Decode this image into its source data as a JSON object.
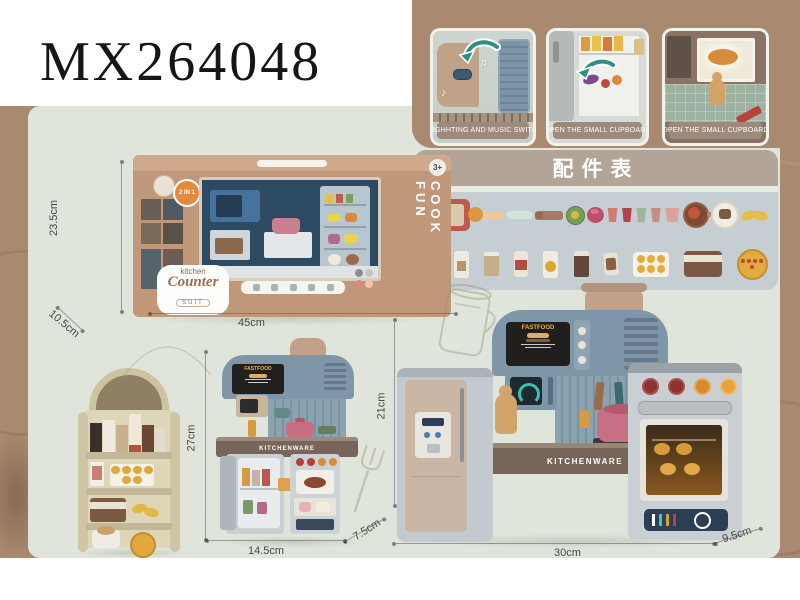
{
  "page": {
    "model_number": "MX264048"
  },
  "feature_photos": [
    {
      "caption": "LIGHHTING AND MUSIC SWITH"
    },
    {
      "caption": "OPEN THE SMALL CUPBOARD"
    },
    {
      "caption": "OPEN THE SMALL CUPBOARD"
    }
  ],
  "accessories_panel": {
    "title": "配件表",
    "rows": [
      {
        "items": [
          {
            "name": "serving-tray",
            "style": "width:46px;height:32px;background:#bf5a4c;border-radius:6px",
            "inner": "left:6px;top:5px;width:34px;height:22px;background:#dac9ad;border-radius:3px"
          },
          {
            "name": "ladle",
            "style": "width:32px;height:9px;background:#eec79c;border-radius:5px",
            "inner": "left:-4px;top:-4px;width:15px;height:15px;border-radius:50%;background:#e0953f"
          },
          {
            "name": "rolling-pin",
            "style": "width:26px;height:8px;background:#d2e3da;border-radius:4px"
          },
          {
            "name": "fork",
            "style": "width:28px;height:9px;background:#ab7a5e;border-radius:3px",
            "inner": "left:0;top:1px;width:8px;height:7px;background:#9a6a50;border-radius:2px"
          },
          {
            "name": "sauce-jar",
            "style": "width:17px;height:17px;border-radius:50%;background:#74a057;border:1px solid #567f3e",
            "inner": "left:4px;top:4px;width:8px;height:8px;border-radius:50%;background:#d8b84a"
          },
          {
            "name": "pink-bowl",
            "style": "width:17px;height:16px;border-radius:50%;background:#bf4d6a",
            "inner": "left:3px;top:2px;width:9px;height:5px;border-radius:50%;background:#d9748c"
          },
          {
            "name": "cup-pink",
            "style": "width:12px;height:14px;background:#d07c70;clip-path:polygon(10% 0,90% 0,78% 100%,22% 100%)"
          },
          {
            "name": "cup-red",
            "style": "width:12px;height:14px;background:#b2434e;clip-path:polygon(10% 0,90% 0,78% 100%,22% 100%)"
          },
          {
            "name": "cup-green",
            "style": "width:12px;height:14px;background:#9db69a;clip-path:polygon(10% 0,90% 0,78% 100%,22% 100%)"
          },
          {
            "name": "cup-tan",
            "style": "width:12px;height:14px;background:#c09180;clip-path:polygon(10% 0,90% 0,78% 100%,22% 100%)"
          },
          {
            "name": "measuring-cup",
            "style": "width:16px;height:14px;background:#dba39c;clip-path:polygon(6% 0,94% 0,82% 100%,18% 100%)"
          },
          {
            "name": "frying-pan",
            "style": "width:22px;height:22px;border-radius:50%;background:#7d4a33;border:2px solid #93604a",
            "inner": "left:3px;top:3px;width:12px;height:12px;border-radius:50%;background:#c2563c",
            "inner2": "left:22px;top:8px;width:11px;height:5px;background:#c18a70;border-radius:3px"
          },
          {
            "name": "dinner-plate",
            "style": "width:24px;height:24px;border-radius:50%;background:#f2ede3;border:2px solid #dcd4c2",
            "inner": "left:6px;top:6px;width:12px;height:10px;background:#7c5c40;border-radius:3px"
          },
          {
            "name": "corn-left",
            "style": "width:16px;height:9px;border-radius:50%;background:#e5bc45;transform:rotate(-18deg)"
          },
          {
            "name": "corn-right",
            "style": "width:16px;height:9px;border-radius:50%;background:#e5bc45;margin-left:-8px;transform:rotate(14deg)"
          }
        ]
      },
      {
        "items": [
          {
            "name": "milk-carton-dark",
            "style": "width:15px;height:26px;background:#423731;border-radius:2px",
            "inner": "left:0;top:0;width:15px;height:5px;background:#ece7de;border-radius:2px 2px 0 0"
          },
          {
            "name": "milk-bottle-white",
            "style": "width:15px;height:27px;background:#efeae1;border-radius:3px",
            "inner": "left:3px;top:10px;width:9px;height:10px;background:#b9926e"
          },
          {
            "name": "milk-carton-tan",
            "style": "width:15px;height:24px;background:#c8ad8c;border-radius:2px",
            "inner": "left:0;top:0;width:15px;height:4px;background:#eee9df;border-radius:2px 2px 0 0"
          },
          {
            "name": "sauce-bottle",
            "style": "width:14px;height:26px;background:#ece5d8;border-radius:3px",
            "inner": "left:1px;top:9px;width:12px;height:10px;background:#b34e3c"
          },
          {
            "name": "honey-bottle",
            "style": "width:15px;height:27px;background:#f1ece2;border-radius:3px",
            "inner": "left:2px;top:10px;width:11px;height:11px;border-radius:50%;background:#d9a832"
          },
          {
            "name": "cocoa-carton",
            "style": "width:15px;height:26px;background:#64463a;border-radius:2px",
            "inner": "left:0;top:0;width:15px;height:5px;background:#e9e4da;border-radius:2px 2px 0 0"
          },
          {
            "name": "snack-packet",
            "style": "width:14px;height:22px;background:#e9e1d1;border-radius:2px;transform:rotate(-4deg)",
            "inner": "left:2px;top:5px;width:10px;height:12px;background:#8a5f46;border-radius:2px"
          },
          {
            "name": "egg-tray",
            "style": "width:36px;height:25px;background:#f7f2e5;border-radius:4px",
            "dots": {
              "count": 6,
              "size": 8,
              "color": "#e2ad3f"
            }
          },
          {
            "name": "ice-cream-tub",
            "style": "width:38px;height:26px;background:#7b5843;border-radius:4px",
            "inner": "left:0;top:4px;width:38px;height:7px;background:#eae3d6"
          },
          {
            "name": "pizza",
            "style": "width:27px;height:27px;border-radius:50%;background:#e2ab3e;border:2px solid #c88d2e",
            "dots": {
              "count": 5,
              "size": 4,
              "color": "#b6483a"
            }
          }
        ]
      }
    ]
  },
  "box": {
    "age_badge": "3+",
    "combo_badge": "2 IN 1",
    "side_slogan": "COOK FUN",
    "brand_line1": "kitchen",
    "brand_line2": "Counter",
    "brand_line3": "SUIT"
  },
  "box_dimensions": {
    "height": "23.5cm",
    "depth": "10.5cm",
    "width": "45cm"
  },
  "kitchen_counter_set": {
    "menu_sign": "FASTFOOD",
    "counter_label": "KITCHENWARE",
    "height": "27cm",
    "width": "14.5cm",
    "depth": "7.5cm"
  },
  "large_kitchen_set": {
    "menu_sign": "FASTFOOD",
    "counter_label": "KITCHENWARE",
    "height": "21cm",
    "width": "30cm",
    "depth": "9.5cm"
  },
  "colors": {
    "background_brown": "#a9896f",
    "panel_sage": "#dfe5db",
    "accessories_header": "#b2a496",
    "accessories_body": "#c4ced3",
    "caption_bar": "#9d8a7a",
    "box_tan": "#c09879",
    "accent_teal": "#2f8f84"
  }
}
